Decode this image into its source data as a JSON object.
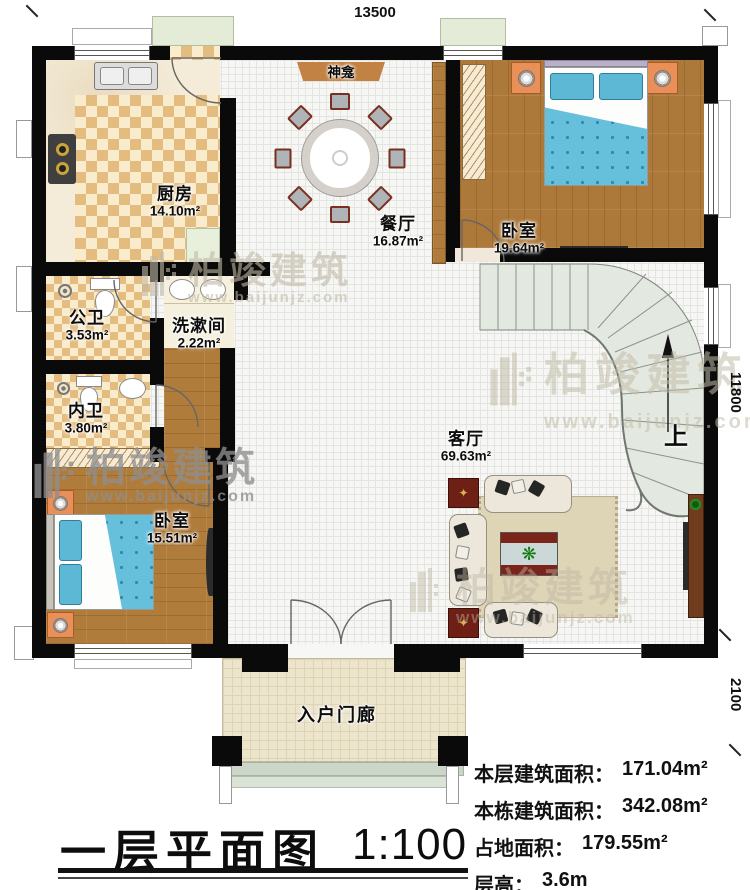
{
  "plan": {
    "dimensions": {
      "top": "13500",
      "right": "11800",
      "bottom_right": "2100"
    },
    "rooms": {
      "kitchen": {
        "name": "厨房",
        "area": "14.10m²"
      },
      "dining": {
        "name": "餐厅",
        "area": "16.87m²"
      },
      "bedroom_top": {
        "name": "卧室",
        "area": "19.64m²"
      },
      "public_bath": {
        "name": "公卫",
        "area": "3.53m²"
      },
      "washroom": {
        "name": "洗漱间",
        "area": "2.22m²"
      },
      "private_bath": {
        "name": "内卫",
        "area": "3.80m²"
      },
      "bedroom_left": {
        "name": "卧室",
        "area": "15.51m²"
      },
      "living": {
        "name": "客厅",
        "area": "69.63m²"
      },
      "porch": {
        "name": "入户门廊"
      }
    },
    "labels": {
      "shrine": "神龛",
      "stairs_up": "上"
    }
  },
  "titleblock": {
    "title": "一层平面图",
    "scale": "1:100",
    "stats": [
      {
        "label": "本层建筑面积：",
        "value": "171.04m²"
      },
      {
        "label": "本栋建筑面积：",
        "value": "342.08m²"
      },
      {
        "label": "占地面积：",
        "value": "179.55m²"
      },
      {
        "label": "层高：",
        "value": "3.6m"
      }
    ]
  },
  "watermark": {
    "brand": "柏竣建筑",
    "url": "www.baijunjz.com"
  },
  "colors": {
    "wall": "#0a0a0a",
    "wood_floor": "#b07c3c",
    "tile_checker": "#e5bc7f",
    "bed_blue": "#66c0dc",
    "stair_green": "#e3e9e0",
    "shrine_brown": "#c28243",
    "nightstand_orange": "#e89058",
    "porch": "#ece4cb"
  }
}
